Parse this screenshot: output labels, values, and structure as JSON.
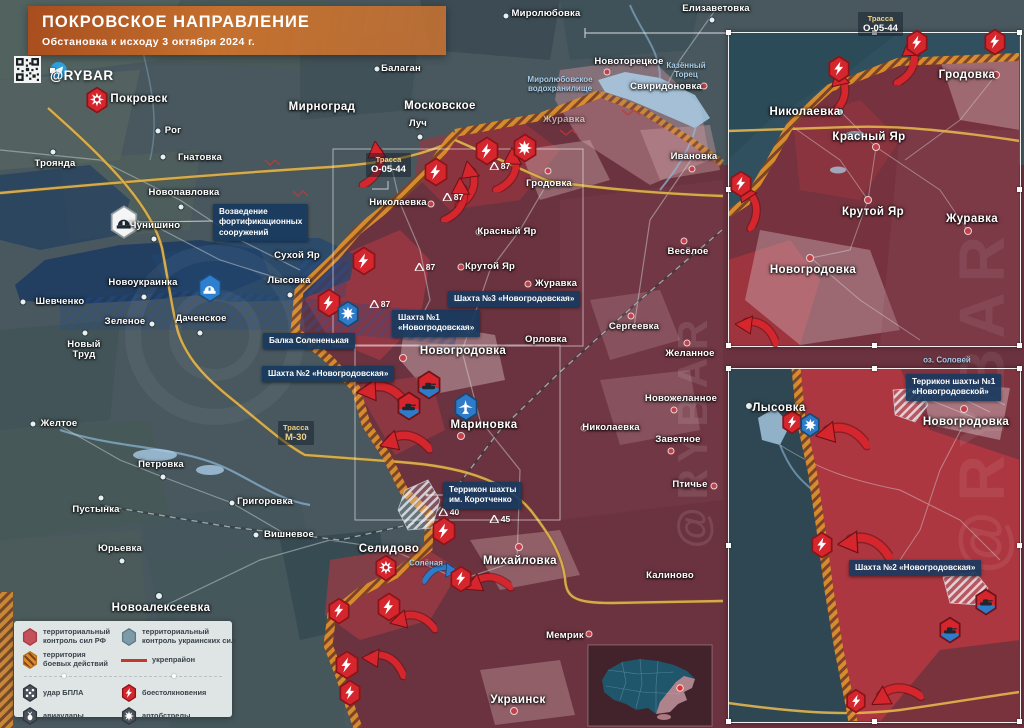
{
  "header": {
    "title": "ПОКРОВСКОЕ НАПРАВЛЕНИЕ",
    "subtitle": "Обстановка к исходу 3 октября 2024 г."
  },
  "branding": {
    "handle": "@RYBAR",
    "watermark": "@RYBAR"
  },
  "colors": {
    "banner_orange": "#c4702f",
    "russian_control": "#6e323d",
    "ukrainian_control": "#48585e",
    "combat_zone_hatch": "#dd8f2e",
    "fortification_navy": "#1c3a60",
    "road_yellow": "#e3b54d",
    "water_blue": "#a9cce6",
    "strike_red": "#d5262e",
    "strike_blue": "#2e7cc9"
  },
  "legend": {
    "items": [
      {
        "icon": "hex-red",
        "label": "территориальный\nконтроль сил РФ"
      },
      {
        "icon": "hex-blue",
        "label": "территориальный\nконтроль украинских сил"
      },
      {
        "icon": "hex-hatch",
        "label": "территория\nбоевых действий"
      },
      {
        "icon": "line-red",
        "label": "укрепрайон"
      },
      {
        "icon": "hex-drone",
        "label": "удар БПЛА"
      },
      {
        "icon": "hex-bolt",
        "label": "боестолкновения"
      },
      {
        "icon": "hex-bomb",
        "label": "авиаудары"
      },
      {
        "icon": "hex-burst",
        "label": "артобстрелы"
      }
    ]
  },
  "map": {
    "towns": [
      {
        "name": "Миролюбовка",
        "x": 546,
        "y": 14,
        "dot": {
          "x": 506,
          "y": 16,
          "c": "w"
        }
      },
      {
        "name": "Елизаветовка",
        "x": 716,
        "y": 9,
        "dot": {
          "x": 712,
          "y": 20,
          "c": "w"
        }
      },
      {
        "name": "Балаган",
        "x": 401,
        "y": 69,
        "dot": {
          "x": 377,
          "y": 69,
          "c": "w"
        }
      },
      {
        "name": "Московское",
        "x": 440,
        "y": 106,
        "big": true,
        "dot": {
          "x": 409,
          "y": 106,
          "c": "w"
        }
      },
      {
        "name": "Луч",
        "x": 418,
        "y": 124,
        "dot": {
          "x": 420,
          "y": 137,
          "c": "w"
        }
      },
      {
        "name": "Мирноград",
        "x": 322,
        "y": 107,
        "big": true,
        "dot": {
          "x": 293,
          "y": 107,
          "c": "w"
        }
      },
      {
        "name": "Покровск",
        "x": 139,
        "y": 99,
        "big": true
      },
      {
        "name": "Рог",
        "x": 173,
        "y": 131,
        "dot": {
          "x": 158,
          "y": 131,
          "c": "w"
        }
      },
      {
        "name": "Гнатовка",
        "x": 200,
        "y": 158,
        "dot": {
          "x": 163,
          "y": 157,
          "c": "w"
        }
      },
      {
        "name": "Троянда",
        "x": 55,
        "y": 164,
        "dot": {
          "x": 53,
          "y": 152,
          "c": "w"
        }
      },
      {
        "name": "Новопавловка",
        "x": 184,
        "y": 193,
        "dot": {
          "x": 181,
          "y": 207,
          "c": "w"
        }
      },
      {
        "name": "Чунишино",
        "x": 155,
        "y": 226,
        "dot": {
          "x": 154,
          "y": 239,
          "c": "w"
        }
      },
      {
        "name": "Новоукраинка",
        "x": 143,
        "y": 283,
        "dot": {
          "x": 144,
          "y": 297,
          "c": "w"
        }
      },
      {
        "name": "Шевченко",
        "x": 60,
        "y": 302,
        "dot": {
          "x": 23,
          "y": 302,
          "c": "w"
        }
      },
      {
        "name": "Зеленое",
        "x": 125,
        "y": 322,
        "dot": {
          "x": 152,
          "y": 324,
          "c": "w"
        }
      },
      {
        "name": "Даченское",
        "x": 201,
        "y": 319,
        "dot": {
          "x": 200,
          "y": 333,
          "c": "w"
        }
      },
      {
        "name": "Новый\nТруд",
        "x": 84,
        "y": 350,
        "dot": {
          "x": 85,
          "y": 333,
          "c": "w"
        }
      },
      {
        "name": "Сухой Яр",
        "x": 297,
        "y": 256
      },
      {
        "name": "Лысовка",
        "x": 289,
        "y": 281,
        "dot": {
          "x": 290,
          "y": 295,
          "c": "w"
        }
      },
      {
        "name": "Желтое",
        "x": 59,
        "y": 424,
        "dot": {
          "x": 33,
          "y": 424,
          "c": "w"
        }
      },
      {
        "name": "Петровка",
        "x": 161,
        "y": 465,
        "dot": {
          "x": 163,
          "y": 477,
          "c": "w"
        }
      },
      {
        "name": "Григоровка",
        "x": 265,
        "y": 502,
        "dot": {
          "x": 232,
          "y": 503,
          "c": "w"
        }
      },
      {
        "name": "Вишневое",
        "x": 289,
        "y": 535,
        "dot": {
          "x": 256,
          "y": 535,
          "c": "w"
        }
      },
      {
        "name": "Пустынка",
        "x": 96,
        "y": 510,
        "dot": {
          "x": 101,
          "y": 498,
          "c": "w"
        }
      },
      {
        "name": "Юрьевка",
        "x": 120,
        "y": 549,
        "dot": {
          "x": 122,
          "y": 561,
          "c": "w"
        }
      },
      {
        "name": "Новоалексеевка",
        "x": 161,
        "y": 608,
        "big": true,
        "dot": {
          "x": 159,
          "y": 596,
          "c": "w"
        }
      },
      {
        "name": "Николаевка",
        "x": 398,
        "y": 203,
        "dot": {
          "x": 431,
          "y": 204,
          "c": "r"
        }
      },
      {
        "name": "Гродовка",
        "x": 549,
        "y": 184,
        "dot": {
          "x": 548,
          "y": 171,
          "c": "r"
        }
      },
      {
        "name": "Красный Яр",
        "x": 507,
        "y": 232,
        "dot": {
          "x": 479,
          "y": 232,
          "c": "r"
        }
      },
      {
        "name": "Крутой Яр",
        "x": 490,
        "y": 267,
        "dot": {
          "x": 461,
          "y": 267,
          "c": "r"
        }
      },
      {
        "name": "Журавка",
        "x": 556,
        "y": 284,
        "dot": {
          "x": 528,
          "y": 284,
          "c": "r"
        }
      },
      {
        "name": "Сергеевка",
        "x": 634,
        "y": 327,
        "dot": {
          "x": 631,
          "y": 316,
          "c": "r"
        }
      },
      {
        "name": "Орловка",
        "x": 546,
        "y": 340
      },
      {
        "name": "Весёлое",
        "x": 688,
        "y": 252,
        "dot": {
          "x": 684,
          "y": 241,
          "c": "r"
        }
      },
      {
        "name": "Желанное",
        "x": 690,
        "y": 354,
        "dot": {
          "x": 687,
          "y": 343,
          "c": "r"
        }
      },
      {
        "name": "Новожеланное",
        "x": 681,
        "y": 399,
        "dot": {
          "x": 674,
          "y": 410,
          "c": "r"
        }
      },
      {
        "name": "Николаевка",
        "x": 611,
        "y": 428,
        "dot": {
          "x": 584,
          "y": 428,
          "c": "r"
        }
      },
      {
        "name": "Заветное",
        "x": 678,
        "y": 440,
        "dot": {
          "x": 671,
          "y": 451,
          "c": "r"
        }
      },
      {
        "name": "Птичье",
        "x": 690,
        "y": 485,
        "dot": {
          "x": 714,
          "y": 486,
          "c": "r"
        }
      },
      {
        "name": "Новогродовка",
        "x": 463,
        "y": 351,
        "big": true,
        "dot": {
          "x": 403,
          "y": 358,
          "c": "r"
        }
      },
      {
        "name": "Мариновка",
        "x": 484,
        "y": 425,
        "big": true,
        "dot": {
          "x": 461,
          "y": 436,
          "c": "r"
        }
      },
      {
        "name": "Селидово",
        "x": 389,
        "y": 549,
        "big": true
      },
      {
        "name": "Михайловка",
        "x": 520,
        "y": 561,
        "big": true,
        "dot": {
          "x": 519,
          "y": 547,
          "c": "r"
        }
      },
      {
        "name": "Калиново",
        "x": 670,
        "y": 576
      },
      {
        "name": "Мемрик",
        "x": 565,
        "y": 636,
        "dot": {
          "x": 589,
          "y": 634,
          "c": "r"
        }
      },
      {
        "name": "Украинск",
        "x": 518,
        "y": 700,
        "big": true,
        "dot": {
          "x": 514,
          "y": 711,
          "c": "r"
        }
      },
      {
        "name": "Ивановка",
        "x": 694,
        "y": 157,
        "dot": {
          "x": 692,
          "y": 169,
          "c": "r"
        }
      },
      {
        "name": "Новоторецкое",
        "x": 629,
        "y": 62,
        "dot": {
          "x": 607,
          "y": 72,
          "c": "r"
        }
      },
      {
        "name": "Свиридоновка",
        "x": 666,
        "y": 87,
        "dot": {
          "x": 704,
          "y": 86,
          "c": "r"
        }
      },
      {
        "name": "Журавка",
        "x": 564,
        "y": 120,
        "op": 0.55
      }
    ],
    "label_boxes": [
      {
        "x": 213,
        "y": 204,
        "lines": [
          "Возведение",
          "фортификационных",
          "сооружений"
        ]
      },
      {
        "x": 263,
        "y": 333,
        "lines": [
          "Балка Солененькая"
        ]
      },
      {
        "x": 392,
        "y": 310,
        "lines": [
          "Шахта №1",
          "«Новогродовская»"
        ]
      },
      {
        "x": 448,
        "y": 291,
        "lines": [
          "Шахта №3 «Новогродовская»"
        ]
      },
      {
        "x": 262,
        "y": 366,
        "lines": [
          "Шахта №2 «Новогродовская»"
        ]
      },
      {
        "x": 443,
        "y": 482,
        "lines": [
          "Террикон шахты",
          "им. Коротченко"
        ]
      }
    ],
    "road_labels": [
      {
        "x": 366,
        "y": 153,
        "t1": "Трасса",
        "t2": "О-05-44",
        "style": "o"
      },
      {
        "x": 278,
        "y": 421,
        "t1": "Трасса",
        "t2": "М-30",
        "style": "m"
      }
    ],
    "water_labels": [
      {
        "x": 560,
        "y": 84,
        "lines": [
          "Миролюбовское",
          "водохранилище"
        ]
      },
      {
        "x": 686,
        "y": 70,
        "lines": [
          "Казённый",
          "Торец"
        ]
      },
      {
        "x": 426,
        "y": 563,
        "lines": [
          "Солёная"
        ]
      }
    ],
    "heights": [
      {
        "v": "87",
        "x": 500,
        "y": 166
      },
      {
        "v": "87",
        "x": 453,
        "y": 197
      },
      {
        "v": "87",
        "x": 425,
        "y": 267
      },
      {
        "v": "87",
        "x": 380,
        "y": 304
      },
      {
        "v": "40",
        "x": 449,
        "y": 512
      },
      {
        "v": "45",
        "x": 500,
        "y": 519
      }
    ],
    "icons": [
      {
        "t": "fire",
        "x": 97,
        "y": 100,
        "s": 24
      },
      {
        "t": "fire",
        "x": 386,
        "y": 568,
        "s": 24
      },
      {
        "t": "burst-red",
        "x": 525,
        "y": 148,
        "s": 26
      },
      {
        "t": "bolt",
        "x": 487,
        "y": 151,
        "s": 26
      },
      {
        "t": "bolt",
        "x": 436,
        "y": 172,
        "s": 26
      },
      {
        "t": "bolt",
        "x": 364,
        "y": 261,
        "s": 26
      },
      {
        "t": "bolt",
        "x": 329,
        "y": 303,
        "s": 26
      },
      {
        "t": "burst-blue",
        "x": 348,
        "y": 314,
        "s": 24
      },
      {
        "t": "bolt",
        "x": 444,
        "y": 531,
        "s": 26
      },
      {
        "t": "bolt",
        "x": 461,
        "y": 579,
        "s": 24
      },
      {
        "t": "bolt",
        "x": 389,
        "y": 607,
        "s": 26
      },
      {
        "t": "bolt",
        "x": 339,
        "y": 611,
        "s": 24
      },
      {
        "t": "bolt",
        "x": 347,
        "y": 665,
        "s": 26
      },
      {
        "t": "bolt",
        "x": 350,
        "y": 693,
        "s": 24
      },
      {
        "t": "tank",
        "x": 429,
        "y": 385,
        "s": 26
      },
      {
        "t": "tank",
        "x": 409,
        "y": 406,
        "s": 26
      },
      {
        "t": "plane",
        "x": 466,
        "y": 407,
        "s": 26
      },
      {
        "t": "fort-white",
        "x": 124,
        "y": 222,
        "s": 30
      },
      {
        "t": "fort-blue",
        "x": 210,
        "y": 288,
        "s": 26
      }
    ],
    "arrows": [
      {
        "x": 507,
        "y": 170,
        "r": 95
      },
      {
        "x": 466,
        "y": 184,
        "r": 85
      },
      {
        "x": 372,
        "y": 164,
        "r": 90
      },
      {
        "x": 455,
        "y": 200,
        "r": 95
      },
      {
        "x": 383,
        "y": 396,
        "r": 0,
        "sc": 1.15
      },
      {
        "x": 405,
        "y": 444,
        "r": -12,
        "sc": 1.1
      },
      {
        "x": 488,
        "y": 585,
        "r": -18
      },
      {
        "x": 413,
        "y": 623,
        "r": -8
      },
      {
        "x": 384,
        "y": 664,
        "r": 8
      },
      {
        "x": 441,
        "y": 574,
        "r": 0,
        "c": "blue",
        "flip": true,
        "sc": 0.8
      }
    ]
  },
  "insets": [
    {
      "id": "inset-1",
      "frame": {
        "x": 728,
        "y": 32,
        "w": 291,
        "h": 313
      },
      "towns": [
        {
          "name": "Николаевка",
          "x": 805,
          "y": 112,
          "big": true,
          "dot": {
            "x": 840,
            "y": 112,
            "c": "w"
          }
        },
        {
          "name": "Гродовка",
          "x": 967,
          "y": 75,
          "big": true,
          "dot": {
            "x": 996,
            "y": 75,
            "c": "r"
          }
        },
        {
          "name": "Красный Яр",
          "x": 869,
          "y": 137,
          "big": true,
          "dot": {
            "x": 876,
            "y": 147,
            "c": "r"
          }
        },
        {
          "name": "Крутой Яр",
          "x": 873,
          "y": 212,
          "big": true,
          "dot": {
            "x": 868,
            "y": 200,
            "c": "r"
          }
        },
        {
          "name": "Журавка",
          "x": 972,
          "y": 219,
          "big": true,
          "dot": {
            "x": 968,
            "y": 231,
            "c": "r"
          }
        },
        {
          "name": "Новогродовка",
          "x": 813,
          "y": 270,
          "big": true,
          "dot": {
            "x": 810,
            "y": 258,
            "c": "r"
          }
        }
      ],
      "label_boxes": [],
      "road_labels": [
        {
          "x": 858,
          "y": 12,
          "t1": "Трасса",
          "t2": "О-05-44",
          "style": "o"
        }
      ],
      "water_labels": [],
      "heights": [],
      "icons": [
        {
          "t": "bolt",
          "x": 917,
          "y": 43,
          "s": 24
        },
        {
          "t": "bolt",
          "x": 995,
          "y": 42,
          "s": 24
        },
        {
          "t": "bolt",
          "x": 839,
          "y": 69,
          "s": 24
        },
        {
          "t": "bolt",
          "x": 741,
          "y": 184,
          "s": 24
        }
      ],
      "arrows": [
        {
          "x": 906,
          "y": 62,
          "r": 90
        },
        {
          "x": 837,
          "y": 92,
          "r": 80
        },
        {
          "x": 748,
          "y": 206,
          "r": 60
        },
        {
          "x": 757,
          "y": 331,
          "r": 10
        }
      ]
    },
    {
      "id": "inset-2",
      "frame": {
        "x": 728,
        "y": 368,
        "w": 291,
        "h": 353
      },
      "towns": [
        {
          "name": "Лысовка",
          "x": 779,
          "y": 408,
          "big": true,
          "dot": {
            "x": 749,
            "y": 406,
            "c": "w"
          }
        },
        {
          "name": "Новогродовка",
          "x": 966,
          "y": 422,
          "big": true,
          "dot": {
            "x": 964,
            "y": 409,
            "c": "r"
          }
        }
      ],
      "label_boxes": [
        {
          "x": 906,
          "y": 374,
          "lines": [
            "Террикон шахты №1",
            "«Новогродовской»"
          ]
        },
        {
          "x": 849,
          "y": 560,
          "lines": [
            "Шахта №2 «Новогродовская»"
          ]
        }
      ],
      "road_labels": [],
      "water_labels": [
        {
          "x": 947,
          "y": 360,
          "lines": [
            "оз. Соловей"
          ]
        }
      ],
      "heights": [],
      "icons": [
        {
          "t": "bolt",
          "x": 792,
          "y": 422,
          "s": 22
        },
        {
          "t": "burst-blue",
          "x": 810,
          "y": 425,
          "s": 22
        },
        {
          "t": "bolt",
          "x": 822,
          "y": 545,
          "s": 24
        },
        {
          "t": "bolt",
          "x": 856,
          "y": 701,
          "s": 22
        },
        {
          "t": "tank",
          "x": 986,
          "y": 602,
          "s": 24
        },
        {
          "t": "tank",
          "x": 950,
          "y": 630,
          "s": 24
        }
      ],
      "arrows": [
        {
          "x": 842,
          "y": 437,
          "r": -5,
          "sc": 1.15
        },
        {
          "x": 865,
          "y": 548,
          "r": 0,
          "sc": 1.2
        },
        {
          "x": 896,
          "y": 697,
          "r": -25,
          "sc": 1.1
        }
      ]
    }
  ],
  "minimap": {
    "type": "ukraine-locator",
    "marker_color": "#e03131"
  }
}
